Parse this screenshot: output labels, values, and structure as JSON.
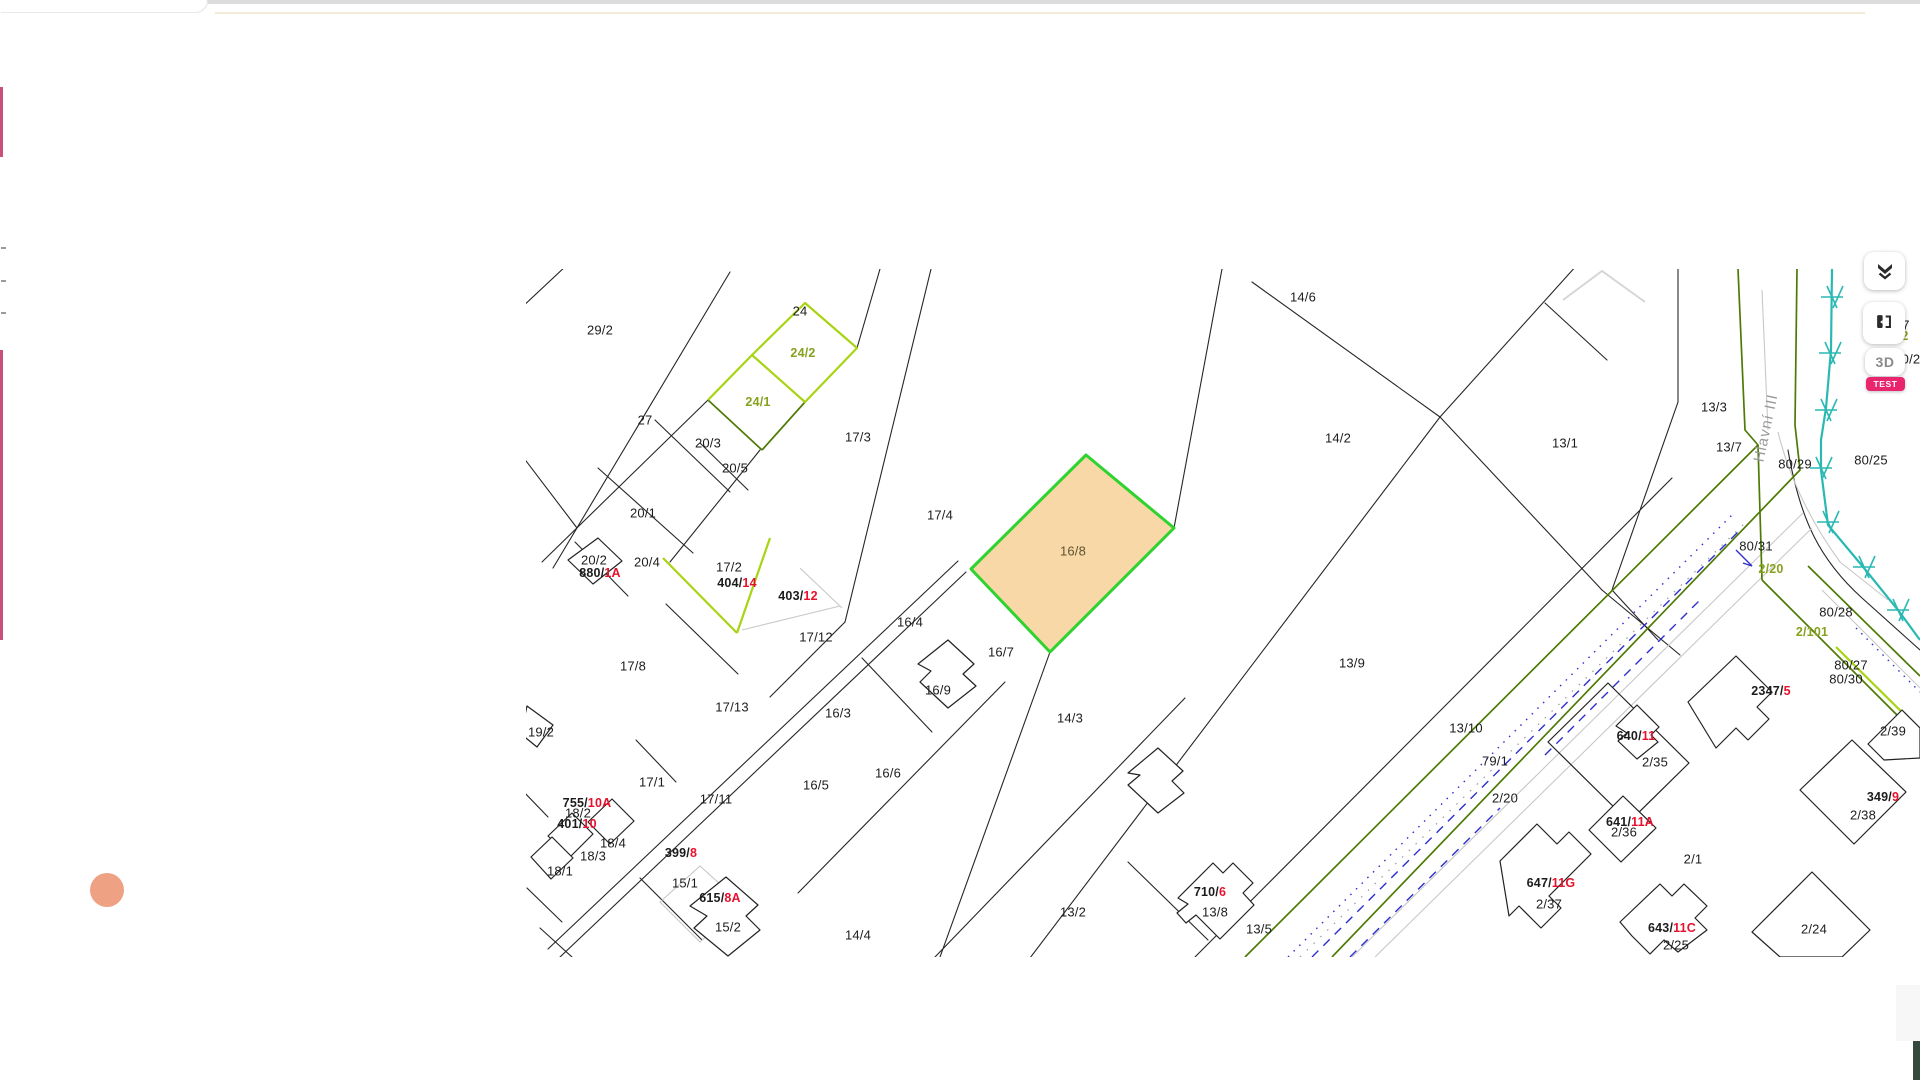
{
  "controls": {
    "three_d_label": "3D",
    "test_badge": "TEST",
    "layers_icon": "layers-collapse-icon",
    "compare_icon": "map-compare-icon"
  },
  "colors": {
    "selection_fill": "#f7d8a6",
    "selection_stroke": "#2fd32f",
    "highlight_green": "#a8d414",
    "road_olive": "#4e7a04",
    "utility_cyan": "#2ab9b2",
    "utility_blue": "#2d2dd0",
    "label_red": "#e8112d",
    "label_olive": "#86a11e",
    "badge_pink": "#e8256d",
    "marker_orange": "#efa183",
    "side_pink": "#c94f7c"
  },
  "map": {
    "selected_parcel": {
      "label": "16/8",
      "x": 1073,
      "y": 551
    },
    "street_label": {
      "text": "Hlavní III",
      "x": 1766,
      "y": 428,
      "rotation": -78
    },
    "black_labels": [
      [
        "29/2",
        600,
        330
      ],
      [
        "24",
        800,
        311
      ],
      [
        "27",
        645,
        420
      ],
      [
        "20/3",
        708,
        443
      ],
      [
        "20/5",
        735,
        468
      ],
      [
        "17/3",
        858,
        437
      ],
      [
        "20/1",
        643,
        513
      ],
      [
        "17/4",
        940,
        515
      ],
      [
        "20/2",
        594,
        560
      ],
      [
        "20/4",
        647,
        562
      ],
      [
        "17/2",
        729,
        567
      ],
      [
        "16/4",
        910,
        622
      ],
      [
        "17/12",
        816,
        637
      ],
      [
        "17/8",
        633,
        666
      ],
      [
        "16/7",
        1001,
        652
      ],
      [
        "16/9",
        938,
        690
      ],
      [
        "17/13",
        732,
        707
      ],
      [
        "16/3",
        838,
        713
      ],
      [
        "14/3",
        1070,
        718
      ],
      [
        "19/2",
        541,
        732
      ],
      [
        "14/6",
        1303,
        297
      ],
      [
        "14/2",
        1338,
        438
      ],
      [
        "13/1",
        1565,
        443
      ],
      [
        "13/3",
        1714,
        407
      ],
      [
        "13/7",
        1729,
        447
      ],
      [
        "80/25",
        1871,
        460
      ],
      [
        "80/29",
        1795,
        464
      ],
      [
        "80/31",
        1756,
        546
      ],
      [
        "80/28",
        1836,
        612
      ],
      [
        "17/1",
        652,
        782
      ],
      [
        "18/2",
        578,
        813
      ],
      [
        "18/4",
        613,
        843
      ],
      [
        "18/3",
        593,
        856
      ],
      [
        "18/1",
        560,
        871
      ],
      [
        "15/1",
        685,
        883
      ],
      [
        "15/2",
        728,
        927
      ],
      [
        "14/4",
        858,
        935
      ],
      [
        "16/5",
        816,
        785
      ],
      [
        "16/6",
        888,
        773
      ],
      [
        "17/11",
        716,
        799
      ],
      [
        "13/9",
        1352,
        663
      ],
      [
        "13/10",
        1466,
        728
      ],
      [
        "79/1",
        1495,
        761
      ],
      [
        "2/20",
        1505,
        798
      ],
      [
        "13/2",
        1073,
        912
      ],
      [
        "13/8",
        1215,
        912
      ],
      [
        "13/5",
        1259,
        929
      ],
      [
        "2/35",
        1655,
        762
      ],
      [
        "2/36",
        1624,
        832
      ],
      [
        "2/1",
        1693,
        859
      ],
      [
        "2/37",
        1549,
        904
      ],
      [
        "2/25",
        1676,
        945
      ],
      [
        "2/24",
        1814,
        929
      ],
      [
        "2/38",
        1863,
        815
      ],
      [
        "2/39",
        1893,
        731
      ],
      [
        "80/27",
        1851,
        665
      ],
      [
        "80/30",
        1846,
        679
      ],
      [
        "7",
        1906,
        325
      ],
      [
        "0/2",
        1911,
        359
      ]
    ],
    "house_labels": [
      [
        "880/",
        "1A",
        600,
        573
      ],
      [
        "404/",
        "14",
        737,
        583
      ],
      [
        "403/",
        "12",
        798,
        596
      ],
      [
        "755/",
        "10A",
        587,
        803
      ],
      [
        "401/",
        "10",
        577,
        824
      ],
      [
        "399/",
        "8",
        681,
        853
      ],
      [
        "615/",
        "8A",
        720,
        898
      ],
      [
        "710/",
        "6",
        1210,
        892
      ],
      [
        "2347/",
        "5",
        1771,
        691
      ],
      [
        "640/",
        "11",
        1636,
        736
      ],
      [
        "641/",
        "11A",
        1630,
        822
      ],
      [
        "647/",
        "11G",
        1551,
        883
      ],
      [
        "643/",
        "11C",
        1672,
        928
      ],
      [
        "349/",
        "9",
        1883,
        797
      ]
    ],
    "olive_labels": [
      [
        "24/2",
        803,
        353
      ],
      [
        "24/1",
        758,
        402
      ],
      [
        "2/20",
        1771,
        569
      ],
      [
        "2/101",
        1812,
        632
      ],
      [
        "2",
        1905,
        336
      ]
    ],
    "red_fragments": [
      [
        "5",
        523,
        772
      ]
    ]
  }
}
